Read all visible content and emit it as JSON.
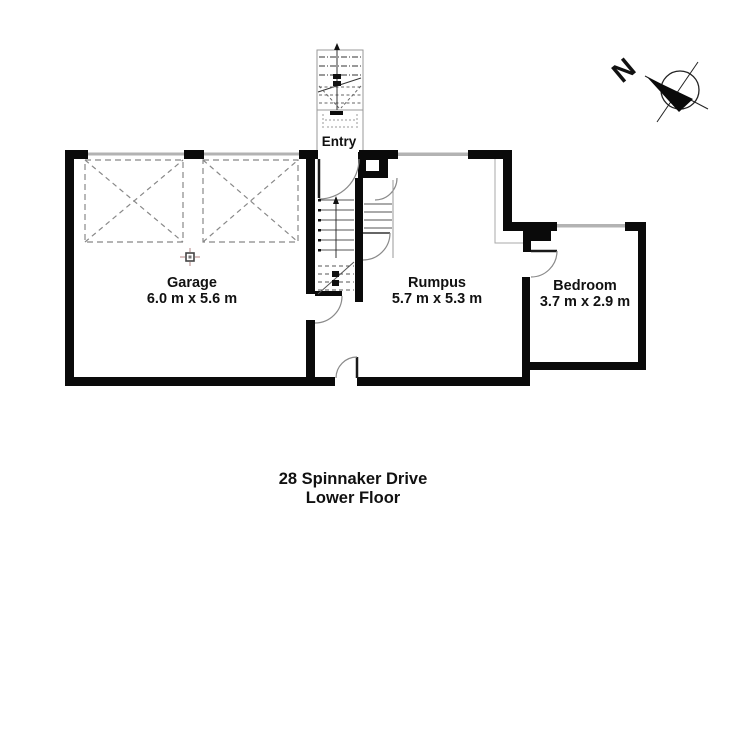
{
  "plan": {
    "entry_label": "Entry",
    "compass_label": "N",
    "rooms": {
      "garage": {
        "name": "Garage",
        "dims": "6.0 m x 5.6 m"
      },
      "rumpus": {
        "name": "Rumpus",
        "dims": "5.7 m x 5.3 m"
      },
      "bedroom": {
        "name": "Bedroom",
        "dims": "3.7 m x 2.9 m"
      }
    }
  },
  "title": {
    "address": "28 Spinnaker Drive",
    "floor": "Lower Floor"
  },
  "colors": {
    "wall": "#0a0a0a",
    "window": "#b3b3b3",
    "stair_line": "#555555",
    "door_arc": "#8a8a8a",
    "dashed_marking": "#888888",
    "fixture_tick": "#c09a9a"
  }
}
